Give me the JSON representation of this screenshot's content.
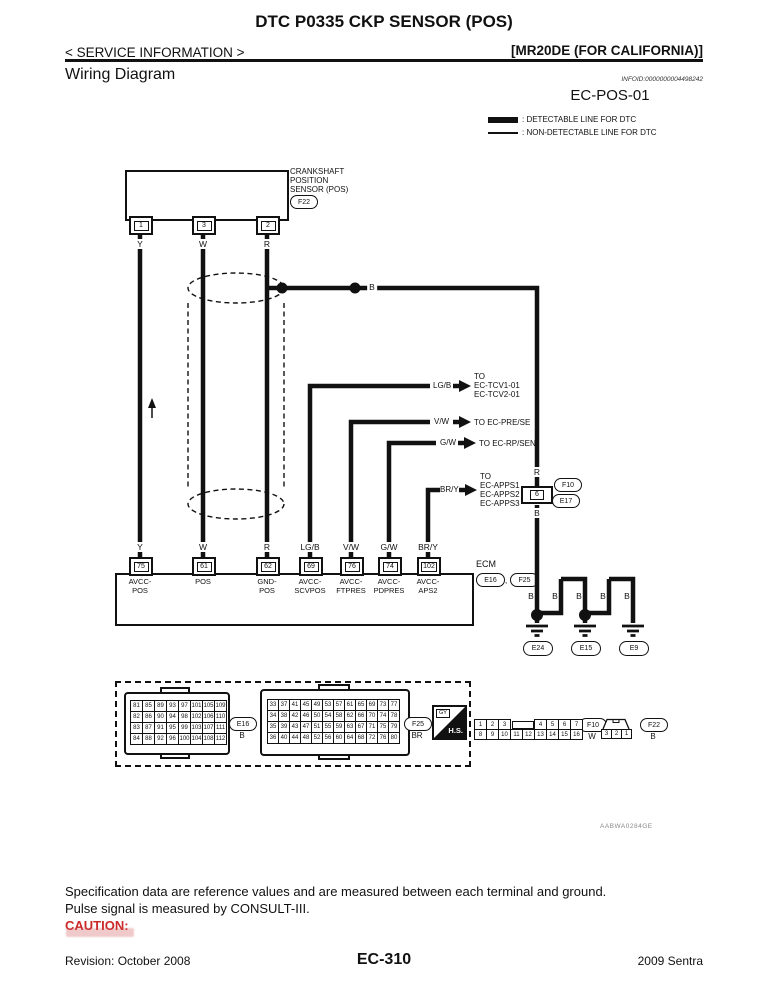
{
  "header": {
    "title": "DTC P0335 CKP SENSOR (POS)",
    "breadcrumb": "< SERVICE INFORMATION >",
    "variant": "[MR20DE (FOR CALIFORNIA)]",
    "section": "Wiring Diagram",
    "infoid": "INFOID:0000000004498242",
    "diagram_id": "EC-POS-01"
  },
  "legend": {
    "detectable": ": DETECTABLE LINE FOR DTC",
    "non_detectable": ": NON-DETECTABLE LINE FOR DTC"
  },
  "diagram": {
    "sensor": {
      "line1": "CRANKSHAFT",
      "line2": "POSITION",
      "line3": "SENSOR (POS)",
      "connector": "F22",
      "pin1": "1",
      "pin2": "3",
      "pin3": "2",
      "wire1": "Y",
      "wire2": "W",
      "wire3": "R"
    },
    "splice_label": "B",
    "branches": [
      {
        "wire": "LG/B",
        "to1": "TO",
        "to2": "EC-TCV1-01",
        "to3": "EC-TCV2-01"
      },
      {
        "wire": "V/W",
        "to1": "TO EC-PRE/SE"
      },
      {
        "wire": "G/W",
        "to1": "TO EC-RP/SEN"
      },
      {
        "wire": "BR/Y",
        "to1": "TO",
        "to2": "EC-APPS1",
        "to3": "EC-APPS2",
        "to4": "EC-APPS3"
      }
    ],
    "inline_connector": {
      "wire_above": "R",
      "pin": "6",
      "conn1": "F10",
      "conn2": "E17",
      "wire_below": "B"
    },
    "ecm": {
      "label": "ECM",
      "conn1": "E16",
      "sep": ",",
      "conn2": "F25",
      "terminals": [
        {
          "wire": "Y",
          "pin": "75",
          "name1": "AVCC-",
          "name2": "POS"
        },
        {
          "wire": "W",
          "pin": "61",
          "name1": "POS",
          "name2": ""
        },
        {
          "wire": "R",
          "pin": "62",
          "name1": "GND-",
          "name2": "POS"
        },
        {
          "wire": "LG/B",
          "pin": "69",
          "name1": "AVCC-",
          "name2": "SCVPOS"
        },
        {
          "wire": "V/W",
          "pin": "76",
          "name1": "AVCC-",
          "name2": "FTPRES"
        },
        {
          "wire": "G/W",
          "pin": "74",
          "name1": "AVCC-",
          "name2": "PDPRES"
        },
        {
          "wire": "BR/Y",
          "pin": "102",
          "name1": "AVCC-",
          "name2": "APS2"
        }
      ]
    },
    "grounds": {
      "b1": "B",
      "b2": "B",
      "b3": "B",
      "b4": "B",
      "b5": "B",
      "g1": "E24",
      "g2": "E15",
      "g3": "E9"
    },
    "figure_code": "AABWA0284GE"
  },
  "connector_views": {
    "e16": {
      "label": "E16",
      "color": "B",
      "grid": [
        [
          "81",
          "85",
          "89",
          "93",
          "97",
          "101",
          "105",
          "109"
        ],
        [
          "82",
          "86",
          "90",
          "94",
          "98",
          "102",
          "106",
          "110"
        ],
        [
          "83",
          "87",
          "91",
          "95",
          "99",
          "103",
          "107",
          "111"
        ],
        [
          "84",
          "88",
          "92",
          "96",
          "100",
          "104",
          "108",
          "112"
        ]
      ]
    },
    "f25": {
      "label": "F25",
      "color": "BR",
      "grid": [
        [
          "33",
          "37",
          "41",
          "45",
          "49",
          "53",
          "57",
          "61",
          "65",
          "69",
          "73",
          "77"
        ],
        [
          "34",
          "38",
          "42",
          "46",
          "50",
          "54",
          "58",
          "62",
          "66",
          "70",
          "74",
          "78"
        ],
        [
          "35",
          "39",
          "43",
          "47",
          "51",
          "55",
          "59",
          "63",
          "67",
          "71",
          "75",
          "79"
        ],
        [
          "36",
          "40",
          "44",
          "48",
          "52",
          "56",
          "60",
          "64",
          "68",
          "72",
          "76",
          "80"
        ]
      ]
    },
    "hs": {
      "top": "GY",
      "label": "H.S."
    },
    "f10": {
      "label": "F10",
      "color": "W",
      "row1a": [
        "1",
        "2",
        "3"
      ],
      "row1b": [
        "4",
        "5",
        "6",
        "7"
      ],
      "row2": [
        "8",
        "9",
        "10",
        "11",
        "12",
        "13",
        "14",
        "15",
        "16"
      ]
    },
    "f22": {
      "label": "F22",
      "color": "B",
      "cells": [
        "3",
        "2",
        "1"
      ]
    }
  },
  "footer": {
    "note1": "Specification data are reference values and are measured between each terminal and ground.",
    "note2": "Pulse signal is measured by CONSULT-III.",
    "caution": "CAUTION:",
    "revision": "Revision: October 2008",
    "page": "EC-310",
    "model": "2009 Sentra"
  }
}
